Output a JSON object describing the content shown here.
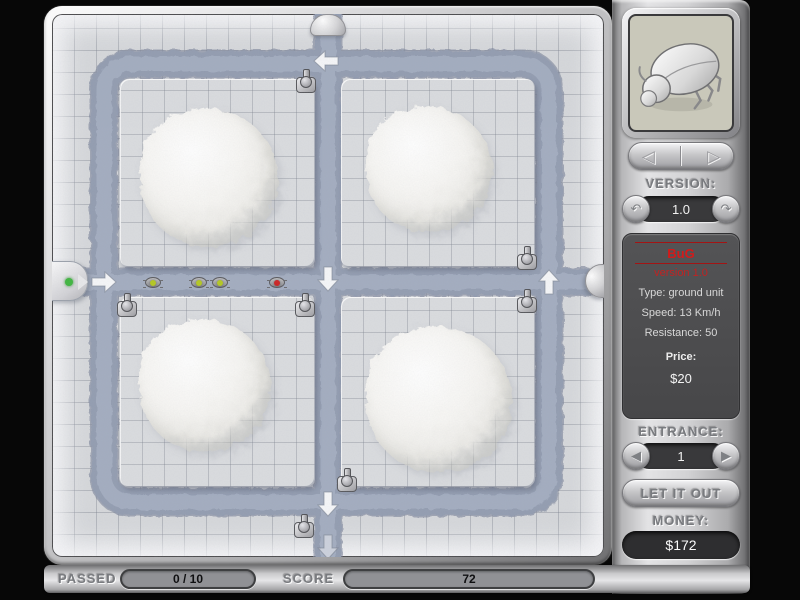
{
  "panel": {
    "preview": {
      "icon": "beetle-icon"
    },
    "nav": {
      "prev_icon": "◁",
      "next_icon": "▷"
    },
    "version": {
      "label": "VERSION:",
      "value": "1.0",
      "prev_icon": "↶",
      "next_icon": "↷"
    },
    "info": {
      "name": "BuG",
      "version": "version 1.0",
      "type": "Type: ground unit",
      "speed": "Speed: 13 Km/h",
      "resistance": "Resistance: 50",
      "price_label": "Price:",
      "price_value": "$20"
    },
    "entrance": {
      "label": "ENTRANCE:",
      "value": "1",
      "prev_icon": "◀",
      "next_icon": "▶"
    },
    "let_it_out_label": "LET IT OUT",
    "money": {
      "label": "MONEY:",
      "value": "$172"
    },
    "check_icon": "✓",
    "sound_icon": "speaker-icon",
    "options_label": "OPTIONS"
  },
  "status_bar": {
    "passed_label": "PASSED",
    "passed_value": "0 / 10",
    "score_label": "SCORE",
    "score_value": "72"
  },
  "board": {
    "colors": {
      "path_dark": "#7e889c",
      "path": "#929cb0",
      "path_light": "#a4aec1",
      "tile": "#d6d8db",
      "bug_green": "#b4c81e",
      "bug_red": "#cc2020"
    },
    "platforms": [
      {
        "x": 68,
        "y": 65,
        "w": 195,
        "h": 188
      },
      {
        "x": 289,
        "y": 65,
        "w": 194,
        "h": 188
      },
      {
        "x": 68,
        "y": 283,
        "w": 195,
        "h": 190
      },
      {
        "x": 289,
        "y": 283,
        "w": 194,
        "h": 190
      }
    ],
    "mounds": [
      {
        "x": 157,
        "y": 163,
        "size": 138
      },
      {
        "x": 377,
        "y": 155,
        "size": 126
      },
      {
        "x": 153,
        "y": 371,
        "size": 132
      },
      {
        "x": 387,
        "y": 385,
        "size": 146
      }
    ],
    "turrets": [
      {
        "x": 254,
        "y": 67
      },
      {
        "x": 475,
        "y": 244
      },
      {
        "x": 75,
        "y": 291
      },
      {
        "x": 253,
        "y": 291
      },
      {
        "x": 475,
        "y": 287
      },
      {
        "x": 295,
        "y": 466
      },
      {
        "x": 252,
        "y": 512
      }
    ],
    "bugs": [
      {
        "x": 101,
        "y": 268,
        "color": "green"
      },
      {
        "x": 147,
        "y": 268,
        "color": "green"
      },
      {
        "x": 168,
        "y": 268,
        "color": "green"
      },
      {
        "x": 225,
        "y": 268,
        "color": "red"
      }
    ],
    "arrows": [
      {
        "x": 52,
        "y": 268,
        "dir": "right",
        "opacity": 0.9
      },
      {
        "x": 274,
        "y": 47,
        "dir": "left",
        "opacity": 0.9
      },
      {
        "x": 276,
        "y": 265,
        "dir": "down",
        "opacity": 0.9
      },
      {
        "x": 497,
        "y": 268,
        "dir": "up",
        "opacity": 0.9
      },
      {
        "x": 276,
        "y": 490,
        "dir": "down",
        "opacity": 0.9
      },
      {
        "x": 276,
        "y": 533,
        "dir": "down",
        "opacity": 0.45
      }
    ],
    "markers": [
      {
        "type": "entry-left",
        "x": -10,
        "y": 247
      },
      {
        "type": "dome-top",
        "x": 258,
        "y": 0
      },
      {
        "type": "dome-right",
        "x": 533,
        "y": 250
      }
    ]
  }
}
